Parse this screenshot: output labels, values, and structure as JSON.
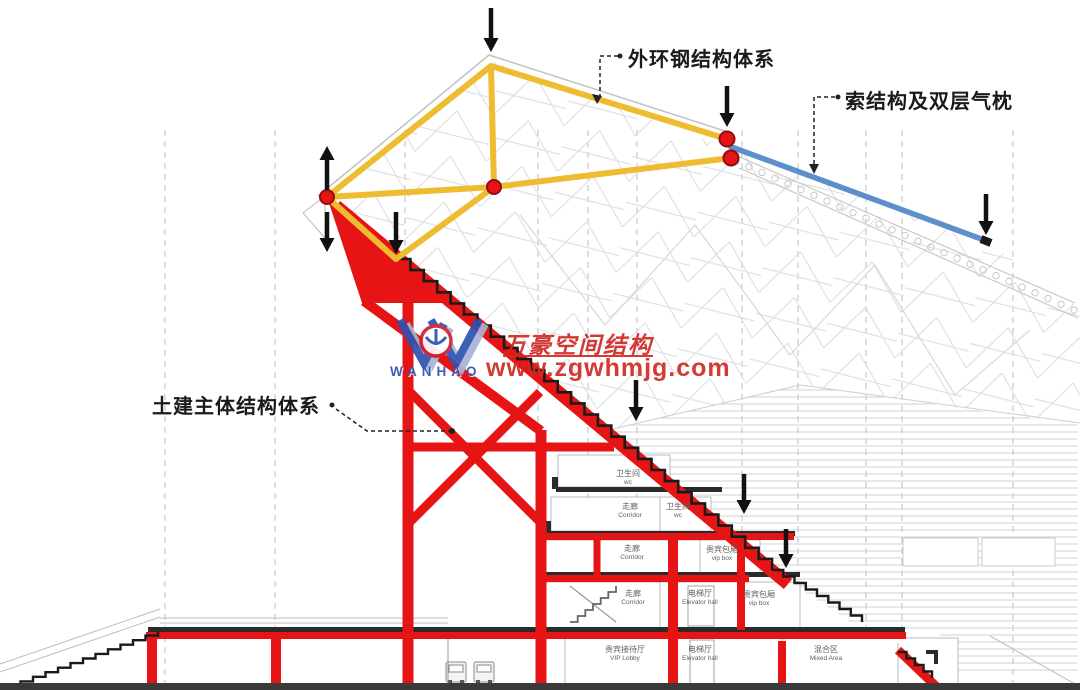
{
  "annotations": {
    "outer_ring": "外环钢结构体系",
    "cable": "索结构及双层气枕",
    "civil": "土建主体结构体系"
  },
  "watermark": {
    "brand": "万豪空间结构",
    "url": "www.zgwhmjg.com",
    "logo_text": "WANHAO"
  },
  "rooms": [
    {
      "cn": "卫生间",
      "en": "wc"
    },
    {
      "cn": "走廊",
      "en": "Corridor"
    },
    {
      "cn": "卫生间",
      "en": "wc"
    },
    {
      "cn": "走廊",
      "en": "Corridor"
    },
    {
      "cn": "贵宾包厢",
      "en": "vip box"
    },
    {
      "cn": "走廊",
      "en": "Corridor"
    },
    {
      "cn": "电梯厅",
      "en": "Elevator hall"
    },
    {
      "cn": "贵宾包厢",
      "en": "vip box"
    },
    {
      "cn": "贵宾接待厅",
      "en": "VIP Lobby"
    },
    {
      "cn": "电梯厅",
      "en": "Elevator hall"
    },
    {
      "cn": "混合区",
      "en": "Mixed Area"
    }
  ],
  "colors": {
    "outer_ring_steel": "#EEBC30",
    "cable": "#5D8FC9",
    "civil_structure": "#E61414",
    "node": "#E61414",
    "load_arrow": "#111111",
    "watermark_red": "#CF2B24",
    "watermark_blue": "#2E52B0"
  }
}
